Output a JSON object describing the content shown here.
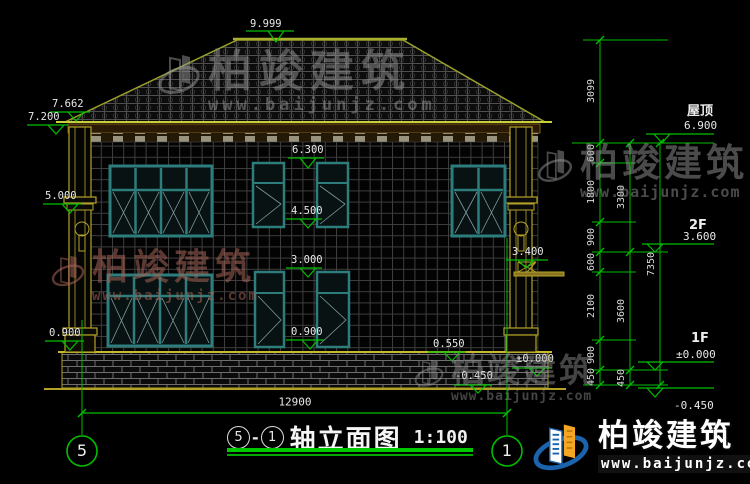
{
  "drawing": {
    "marks": {
      "ridge": "9.999",
      "eave_outer": "7.662",
      "eave": "7.200",
      "left_mid": "5.000",
      "eave_line": "6.300",
      "sill_2f": "4.500",
      "head_1f": "3.000",
      "sill_left": "0.900",
      "sill_mid": "0.900",
      "step": "0.550",
      "canopy": "3.400",
      "floor_1f": "±0.000",
      "ground": "-0.450"
    },
    "overall_width": "12900",
    "axis_left": "5",
    "axis_right": "1"
  },
  "right_dims": {
    "col1": [
      "3099",
      "600",
      "1800",
      "900",
      "600",
      "2100",
      "900",
      "450"
    ],
    "col2": [
      "3300",
      "3600",
      "450"
    ],
    "col3": [
      "7350"
    ]
  },
  "levels": {
    "roof": {
      "label": "屋顶",
      "value": "6.900"
    },
    "f2": {
      "label": "2F",
      "value": "3.600"
    },
    "f1": {
      "label": "1F",
      "value": "±0.000"
    },
    "ground": {
      "value": "-0.450"
    }
  },
  "title_block": {
    "axis_a": "5",
    "sep": "-",
    "axis_b": "1",
    "name": "轴立面图",
    "scale": "1:100"
  },
  "watermark": {
    "name": "柏竣建筑",
    "url": "www.baijunjz.com"
  },
  "brand": {
    "name": "柏竣建筑",
    "url": "www.baijunjz.com"
  },
  "colors": {
    "dimension_green": "#00be00",
    "structure_yellow": "#b3a227",
    "window_teal": "#2e7d7d",
    "brand_blue": "#1b63ad",
    "brand_orange": "#f5a623"
  }
}
